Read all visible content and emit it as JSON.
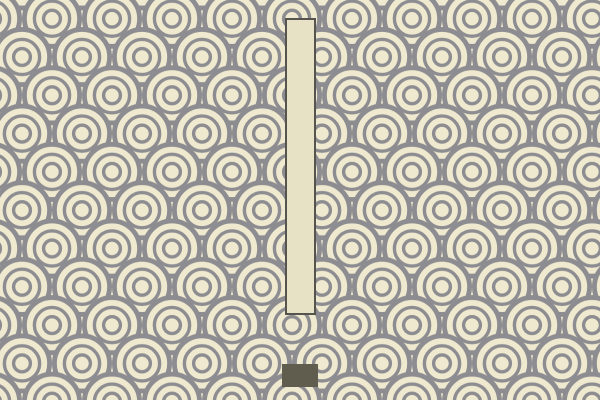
{
  "scene": {
    "kind": "game-scene",
    "background": {
      "name": "seigaiha-wave-pattern",
      "description": "overlapping concentric wave scallops",
      "base_color": "#efe9cf",
      "wave_color": "#8c8c91"
    },
    "obstacle_bar": {
      "name": "vertical-obstacle-bar",
      "fill_color": "#e7e1c6",
      "border_color": "#56544e"
    },
    "player_block": {
      "name": "player-block",
      "fill_color": "#615d4e"
    }
  },
  "colors": {
    "pattern_base": "#efe9cf",
    "pattern_wave": "#8c8c91",
    "bar_fill": "#e7e1c6",
    "bar_border": "#56544e",
    "block_fill": "#615d4e"
  }
}
